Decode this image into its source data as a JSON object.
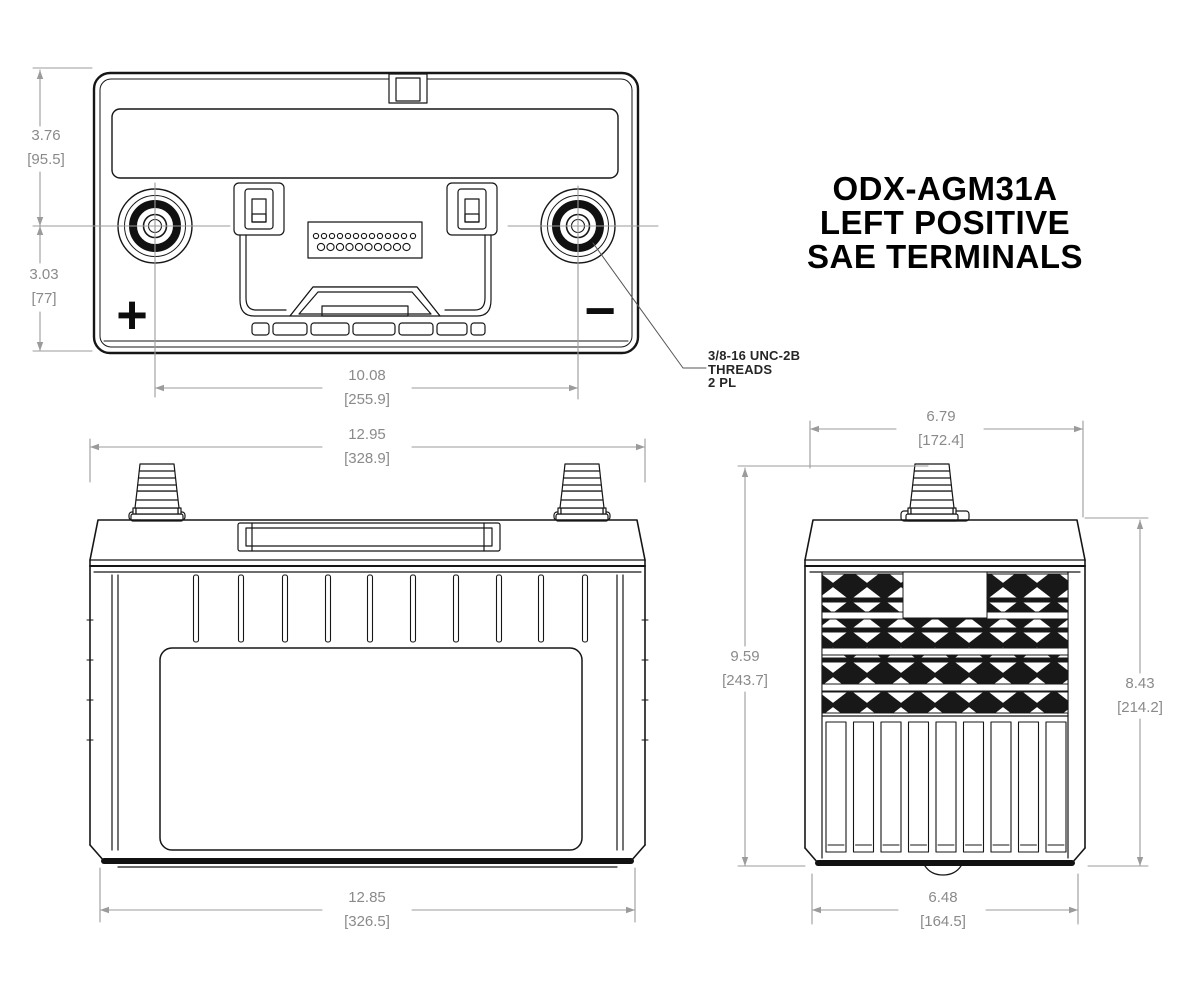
{
  "title": {
    "line1": "ODX-AGM31A",
    "line2": "LEFT POSITIVE",
    "line3": "SAE TERMINALS"
  },
  "callout": {
    "line1": "3/8-16 UNC-2B",
    "line2": "THREADS",
    "line3": "2 PL"
  },
  "symbols": {
    "positive": "+",
    "negative": "−"
  },
  "dimensions": {
    "top_height_upper": {
      "in": "3.76",
      "mm": "[95.5]"
    },
    "top_height_lower": {
      "in": "3.03",
      "mm": "[77]"
    },
    "terminal_spacing": {
      "in": "10.08",
      "mm": "[255.9]"
    },
    "front_width_top": {
      "in": "12.95",
      "mm": "[328.9]"
    },
    "front_width_bottom": {
      "in": "12.85",
      "mm": "[326.5]"
    },
    "side_width_top": {
      "in": "6.79",
      "mm": "[172.4]"
    },
    "side_width_bottom": {
      "in": "6.48",
      "mm": "[164.5]"
    },
    "side_height_total": {
      "in": "9.59",
      "mm": "[243.7]"
    },
    "side_height_case": {
      "in": "8.43",
      "mm": "[214.2]"
    }
  },
  "colors": {
    "line": "#161616",
    "dimension": "#9b9b9b",
    "dimension_text": "#8a8a8a",
    "background": "#ffffff"
  }
}
